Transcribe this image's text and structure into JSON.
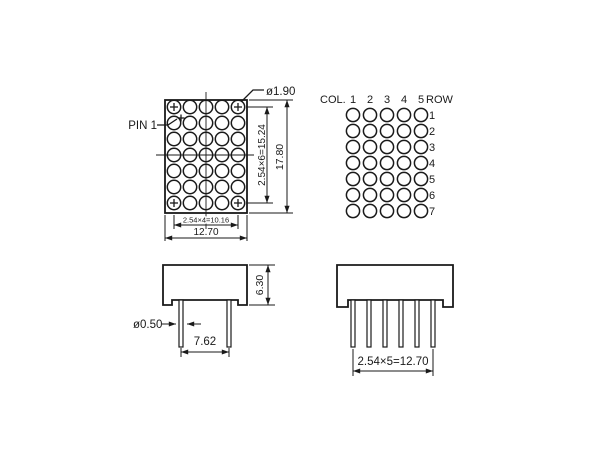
{
  "drawing": {
    "colors": {
      "line": "#1a1a1a",
      "background": "#ffffff"
    },
    "front_view": {
      "pin1_label": "PIN 1",
      "hole_dia_label": "ø1.90",
      "dim_row_pitch": "2.54×6=15.24",
      "dim_overall_height": "17.80",
      "dim_col_pitch": "2.54×4=10.16",
      "dim_overall_width": "12.70",
      "grid": {
        "cols": 5,
        "rows": 7
      }
    },
    "dot_matrix_map": {
      "col_label": "COL.",
      "col_numbers": [
        "1",
        "2",
        "3",
        "4",
        "5"
      ],
      "row_label": "ROW",
      "row_numbers": [
        "1",
        "2",
        "3",
        "4",
        "5",
        "6",
        "7"
      ],
      "grid": {
        "cols": 5,
        "rows": 7
      }
    },
    "side_view_front": {
      "dim_body_height": "6.30",
      "dim_pin_dia": "ø0.50",
      "dim_pin_spacing": "7.62"
    },
    "side_view_side": {
      "dim_pin_pitch": "2.54×5=12.70"
    }
  }
}
